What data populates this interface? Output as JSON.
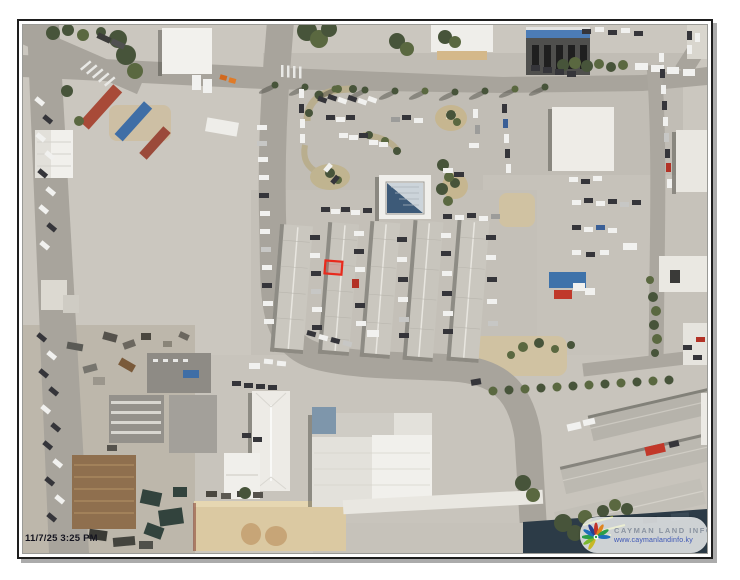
{
  "map": {
    "timestamp": "11/7/25 3:25 PM",
    "parcel": {
      "highlight_color": "#e8291c"
    }
  },
  "logo": {
    "icon": "starburst-logo-icon",
    "title": "CAYMAN LAND INFO",
    "url": "www.caymanlandinfo.ky",
    "title_color": "#8a93a0",
    "url_color": "#3c55b4"
  }
}
